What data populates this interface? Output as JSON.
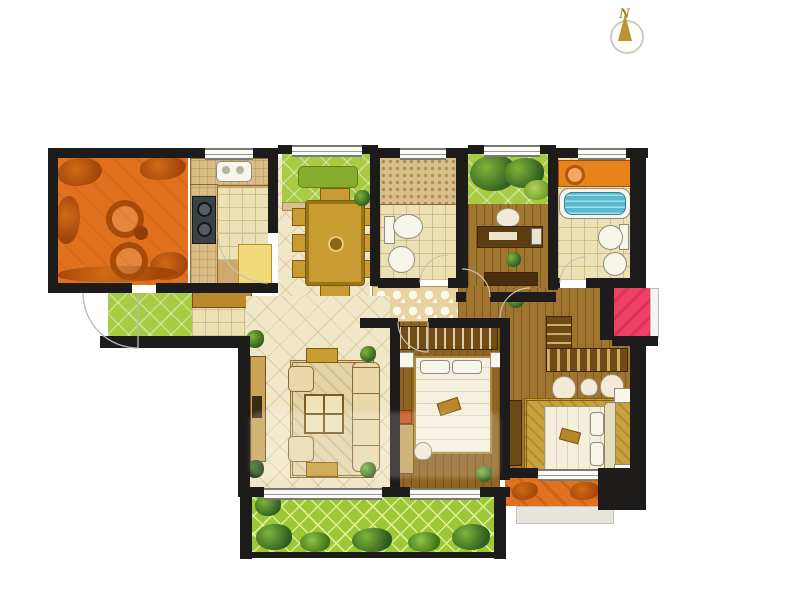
{
  "compass": {
    "label": "N"
  },
  "colors": {
    "wall": "#1d1c1a",
    "terrace": "#e0721f",
    "green": "#a9cb43",
    "lawn": "#9cc736",
    "cream": "#f0e7c8",
    "tileLight": "#ece0b5",
    "wood": "#a0752f",
    "woodDark": "#8f6423",
    "gold": "#c89b33",
    "counter": "#d9bd85",
    "tubBlue": "#56b9ce",
    "pink": "#ee4166",
    "orangeShelf": "#e8831c"
  },
  "rooms": [
    {
      "id": "terrace",
      "label": "terrace"
    },
    {
      "id": "kitchen",
      "label": "kitchen"
    },
    {
      "id": "entry",
      "label": "entry"
    },
    {
      "id": "dining-room",
      "label": "dining-room"
    },
    {
      "id": "north-balcony",
      "label": "north-balcony"
    },
    {
      "id": "bathroom",
      "label": "bathroom"
    },
    {
      "id": "study",
      "label": "study"
    },
    {
      "id": "garden-nook",
      "label": "garden-nook"
    },
    {
      "id": "master-bathroom",
      "label": "master-bathroom"
    },
    {
      "id": "hallway",
      "label": "hallway"
    },
    {
      "id": "living-room",
      "label": "living-room"
    },
    {
      "id": "bedroom",
      "label": "bedroom"
    },
    {
      "id": "master-bedroom",
      "label": "master-bedroom"
    },
    {
      "id": "south-balcony",
      "label": "south-balcony"
    },
    {
      "id": "master-balcony",
      "label": "master-balcony"
    },
    {
      "id": "side-balcony",
      "label": "side-balcony"
    }
  ]
}
